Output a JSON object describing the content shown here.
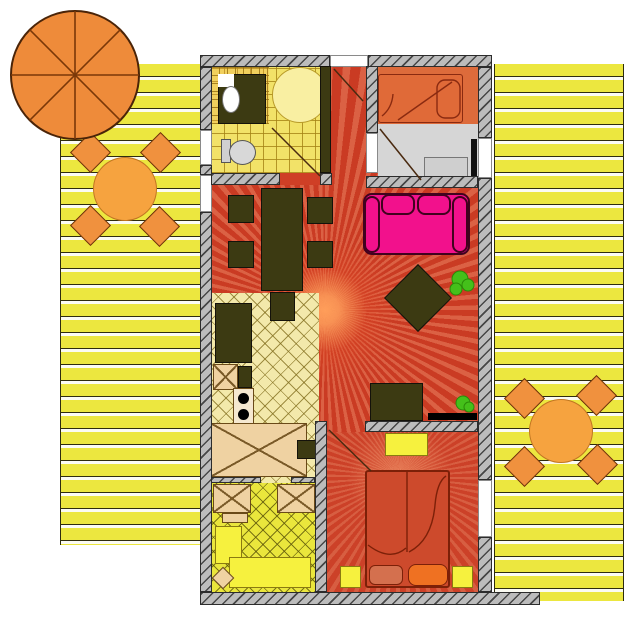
{
  "scene": {
    "type": "apartment-floor-plan",
    "description": "Top-down floor plan of a holiday apartment flanked by two yellow plank sun decks with orange patio sets and a parasol."
  },
  "palette": {
    "deck_plank": "#ece73f",
    "deck_line": "#2e2c0e",
    "wall_fill": "#bcbcbc",
    "floor_red": "#cf3f26",
    "floor_red_deep": "#cc4128",
    "kitchen_floor": "#f3e9ab",
    "bath_tile": "#f2e268",
    "room_yellow": "#eae63c",
    "bedroom_orange": "#dd6b3b",
    "floor_gray": "#d6d6d6",
    "furniture_dark": "#3c3a12",
    "sofa_pink": "#f2118c",
    "bed_single_orange": "#e06a38",
    "bed_double_red": "#cd4a2c",
    "table_orange": "#f6a33f",
    "chair_orange": "#f0913e",
    "parasol_orange": "#ee8b3a",
    "plant_green": "#44c01a",
    "accent_yellow": "#f6f13e"
  },
  "outdoor": {
    "left_deck": {
      "label": "left sun deck",
      "patio_set": {
        "table": "round table",
        "chairs": 4
      },
      "parasol": "parasol"
    },
    "right_deck": {
      "label": "right sun deck",
      "patio_set": {
        "table": "round table",
        "chairs": 4
      }
    }
  },
  "rooms": [
    {
      "name": "bathroom",
      "fixtures": [
        "vanity-sink",
        "corner-shower",
        "toilet"
      ]
    },
    {
      "name": "entry-hallway",
      "fixtures": [
        "entrance-door"
      ]
    },
    {
      "name": "bedroom-top",
      "fixtures": [
        "single-bed",
        "sideboard",
        "deck-door"
      ]
    },
    {
      "name": "living-room",
      "fixtures": [
        "dining-table",
        "dining-chairs",
        "sofa",
        "coffee-table",
        "tv-stand",
        "tv",
        "plants"
      ]
    },
    {
      "name": "kitchen",
      "fixtures": [
        "counter",
        "stove",
        "cabinets"
      ]
    },
    {
      "name": "utility-room",
      "fixtures": [
        "cabinets",
        "bench"
      ]
    },
    {
      "name": "bedroom-bottom",
      "fixtures": [
        "double-bed",
        "nightstands",
        "dresser"
      ]
    }
  ]
}
